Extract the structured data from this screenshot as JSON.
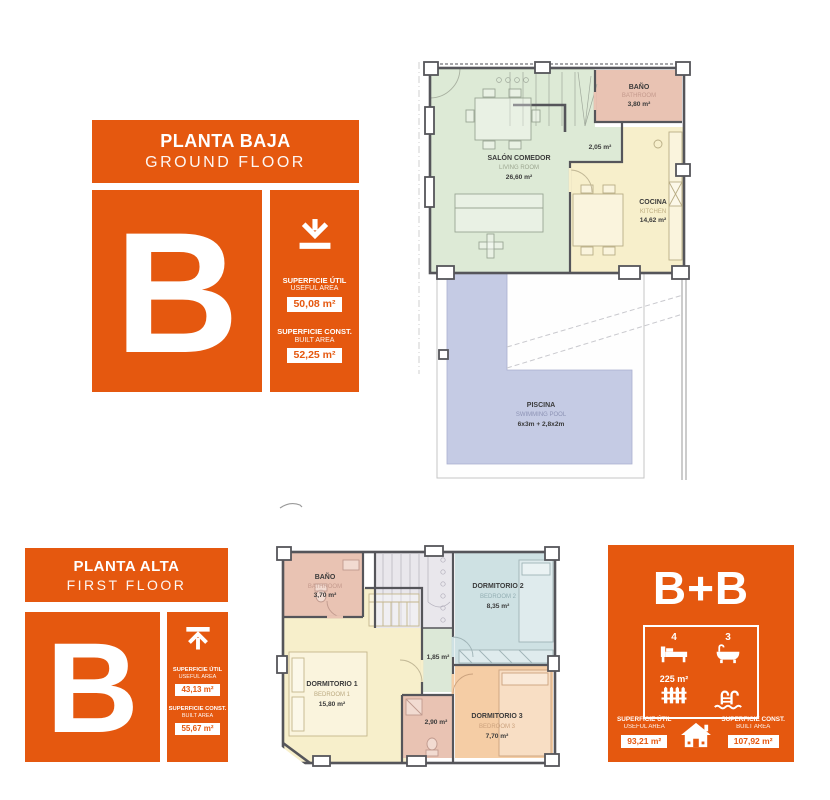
{
  "colors": {
    "accent": "#E5580F",
    "wall": "#55555A"
  },
  "plan_colors": {
    "living": "#DDEAD6",
    "kitchen": "#F7EFCB",
    "bathroom": "#E9C3B3",
    "pool": "#C5CBE4",
    "bedroom1": "#F7EFCB",
    "bedroom2": "#CEE1E3",
    "bedroom3": "#F5CDA5",
    "hall": "#DCE8D7",
    "stairs": "#E9E7EC"
  },
  "ground_panel": {
    "title_es": "PLANTA BAJA",
    "title_en": "GROUND FLOOR",
    "letter": "B",
    "useful_es": "SUPERFICIE ÚTIL",
    "useful_en": "USEFUL AREA",
    "useful_value": "50,08 m²",
    "built_es": "SUPERFICIE CONST.",
    "built_en": "BUILT AREA",
    "built_value": "52,25 m²"
  },
  "first_panel": {
    "title_es": "PLANTA ALTA",
    "title_en": "FIRST FLOOR",
    "letter": "B",
    "useful_es": "SUPERFICIE ÚTIL",
    "useful_en": "USEFUL AREA",
    "useful_value": "43,13 m²",
    "built_es": "SUPERFICIE CONST.",
    "built_en": "BUILT AREA",
    "built_value": "55,67 m²"
  },
  "summary_panel": {
    "title": "B+B",
    "bedrooms": "4",
    "bathrooms": "3",
    "plot_area": "225 m²",
    "useful_es": "SUPERFICIE ÚTIL",
    "useful_en": "USEFUL AREA",
    "useful_value": "93,21 m²",
    "built_es": "SUPERFICIE CONST.",
    "built_en": "BUILT AREA",
    "built_value": "107,92 m²"
  },
  "ground_plan": {
    "salon_es": "SALÓN COMEDOR",
    "salon_en": "LIVING ROOM",
    "salon_area": "26,60 m²",
    "bano_es": "BAÑO",
    "bano_en": "BATHROOM",
    "bano_area": "3,80 m²",
    "hall_area": "2,05 m²",
    "cocina_es": "COCINA",
    "cocina_en": "KITCHEN",
    "cocina_area": "14,62 m²",
    "piscina_es": "PISCINA",
    "piscina_en": "SWIMMING POOL",
    "piscina_dims": "6x3m + 2,8x2m"
  },
  "first_plan": {
    "bano_es": "BAÑO",
    "bano_en": "BATHROOM",
    "bano_area": "3,70 m²",
    "dorm2_es": "DORMITORIO 2",
    "dorm2_en": "BEDROOM 2",
    "dorm2_area": "8,35 m²",
    "dorm1_es": "DORMITORIO 1",
    "dorm1_en": "BEDROOM 1",
    "dorm1_area": "15,80 m²",
    "hall_area": "1,85 m²",
    "aseo_area": "2,90 m²",
    "dorm3_es": "DORMITORIO 3",
    "dorm3_en": "BEDROOM 3",
    "dorm3_area": "7,70 m²"
  }
}
